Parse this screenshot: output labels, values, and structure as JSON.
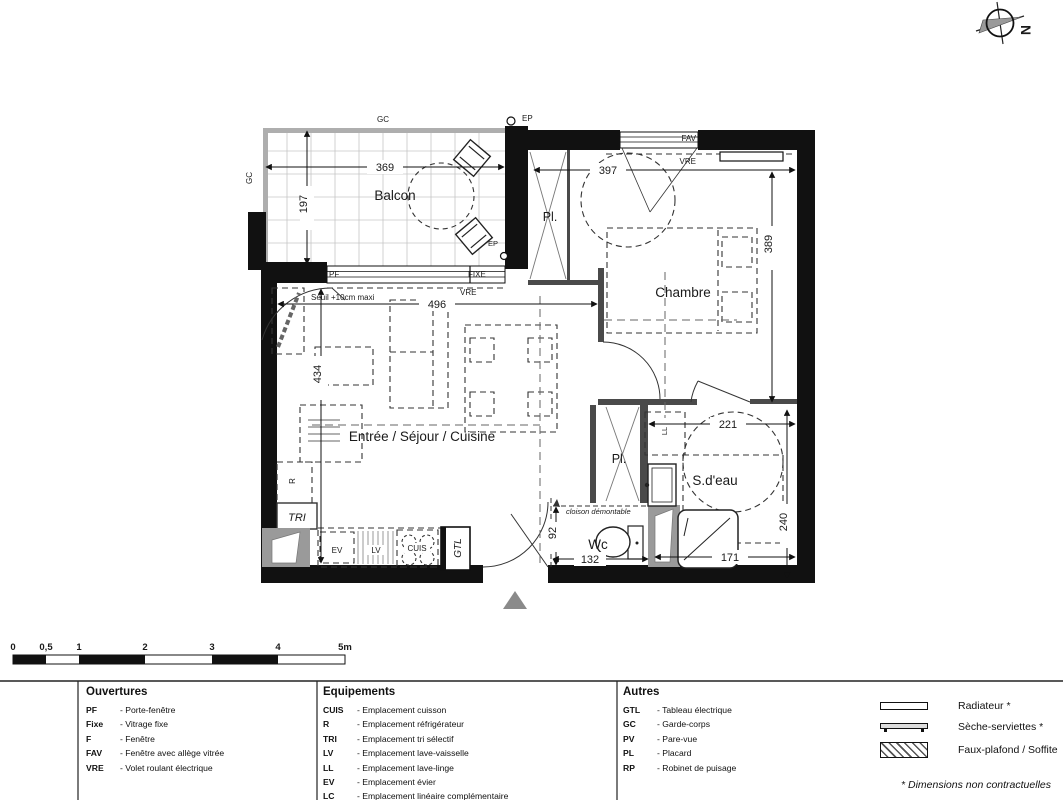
{
  "compass": {
    "north": "N"
  },
  "plan": {
    "rooms": {
      "balcon": "Balcon",
      "chambre": "Chambre",
      "sejour": "Entrée / Séjour / Cuisine",
      "sdeau": "S.d'eau",
      "wc": "Wc",
      "placard": "Pl."
    },
    "dims": {
      "balcon_w": "369",
      "balcon_h": "197",
      "sejour_w": "496",
      "sejour_h": "434",
      "chambre_w": "397",
      "chambre_h": "389",
      "sdeau_w": "221",
      "sdeau_h": "240",
      "shower_w": "171",
      "wc_w": "132",
      "wc_h": "92"
    },
    "openings": {
      "gc": "GC",
      "ep": "EP",
      "pf": "PF",
      "fixe": "FIXE",
      "vre": "VRE",
      "fav": "FAV"
    },
    "equipment": {
      "r": "R",
      "tri": "TRI",
      "ev": "EV",
      "lv": "LV",
      "cuis": "CUIS",
      "gtl": "GTL",
      "ll": "LL"
    },
    "notes": {
      "seuil": "Seuil +10cm maxi",
      "cloison": "cloison démontable"
    }
  },
  "scalebar": {
    "ticks": [
      "0",
      "0,5",
      "1",
      "2",
      "3",
      "4",
      "5m"
    ]
  },
  "legend": {
    "ouvertures": {
      "title": "Ouvertures",
      "items": [
        {
          "abbr": "PF",
          "desc": "- Porte-fenêtre"
        },
        {
          "abbr": "Fixe",
          "desc": "- Vitrage fixe"
        },
        {
          "abbr": "F",
          "desc": "- Fenêtre"
        },
        {
          "abbr": "FAV",
          "desc": "- Fenêtre avec allège vitrée"
        },
        {
          "abbr": "VRE",
          "desc": "- Volet roulant électrique"
        }
      ]
    },
    "equipements": {
      "title": "Equipements",
      "items": [
        {
          "abbr": "CUIS",
          "desc": "- Emplacement cuisson"
        },
        {
          "abbr": "R",
          "desc": "- Emplacement réfrigérateur"
        },
        {
          "abbr": "TRI",
          "desc": "- Emplacement tri sélectif"
        },
        {
          "abbr": "LV",
          "desc": "- Emplacement lave-vaisselle"
        },
        {
          "abbr": "LL",
          "desc": "- Emplacement lave-linge"
        },
        {
          "abbr": "EV",
          "desc": "- Emplacement évier"
        },
        {
          "abbr": "LC",
          "desc": "- Emplacement linéaire complémentaire"
        }
      ]
    },
    "autres": {
      "title": "Autres",
      "items": [
        {
          "abbr": "GTL",
          "desc": "- Tableau électrique"
        },
        {
          "abbr": "GC",
          "desc": "- Garde-corps"
        },
        {
          "abbr": "PV",
          "desc": "- Pare-vue"
        },
        {
          "abbr": "PL",
          "desc": "- Placard"
        },
        {
          "abbr": "RP",
          "desc": "- Robinet de puisage"
        }
      ]
    },
    "symbols": [
      {
        "label": "Radiateur *"
      },
      {
        "label": "Sèche-serviettes *"
      },
      {
        "label": "Faux-plafond / Soffite"
      }
    ],
    "footnote": "* Dimensions non contractuelles"
  }
}
